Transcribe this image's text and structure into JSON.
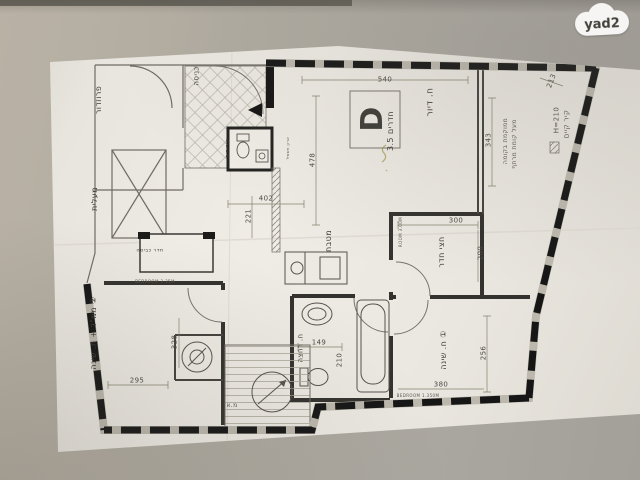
{
  "watermark": {
    "brand": "yad2"
  },
  "floor_plan": {
    "unit": {
      "letter": "D",
      "type_label": "חדרים 3.5",
      "name": "ח. דיור"
    },
    "rooms": [
      {
        "id": "unit-letter",
        "text": "D",
        "x": 373,
        "y": 119,
        "rot": -90,
        "size": 30,
        "bold": true
      },
      {
        "id": "unit-type",
        "text": "חדרים 3.5",
        "x": 391,
        "y": 131,
        "rot": -90,
        "size": 8
      },
      {
        "id": "living-room",
        "text": "ח. דיור",
        "x": 431,
        "y": 102,
        "rot": -90,
        "size": 9
      },
      {
        "id": "kitchen",
        "text": "מטבח",
        "x": 329,
        "y": 241,
        "rot": -90,
        "size": 8
      },
      {
        "id": "half-room",
        "text": "חצי חדר",
        "x": 442,
        "y": 252,
        "rot": -90,
        "size": 8
      },
      {
        "id": "bedroom-1",
        "text": "ח. שינה ①",
        "x": 444,
        "y": 350,
        "rot": -90,
        "size": 8
      },
      {
        "id": "bedroom-2-mamad",
        "text": "ממ\"ד + ח. שינה ②",
        "x": 94,
        "y": 333,
        "rot": -90,
        "size": 8
      },
      {
        "id": "bathroom",
        "text": "ח. רחצה",
        "x": 301,
        "y": 348,
        "rot": -90,
        "size": 7
      },
      {
        "id": "corridor",
        "text": "פרוזדור",
        "x": 99,
        "y": 100,
        "rot": -90,
        "size": 8
      },
      {
        "id": "elevator",
        "text": "מעלית",
        "x": 95,
        "y": 199,
        "rot": -90,
        "size": 8
      },
      {
        "id": "entrance",
        "text": "כניסה",
        "x": 197,
        "y": 76,
        "rot": -90,
        "size": 7
      },
      {
        "id": "laundry",
        "text": "חדר כביסה",
        "x": 150,
        "y": 251,
        "rot": 0,
        "size": 5
      },
      {
        "id": "wc",
        "text": "שירותים",
        "x": 228,
        "y": 148,
        "rot": -90,
        "size": 5
      }
    ],
    "notes": [
      {
        "id": "existing-wall",
        "text": "קיר קיים",
        "x": 567,
        "y": 124,
        "rot": -90,
        "size": 7
      },
      {
        "id": "wall-height",
        "text": "H=210",
        "x": 557,
        "y": 120,
        "rot": -90,
        "size": 7
      },
      {
        "id": "balcony-note-1",
        "text": "ממוקמת בקומה",
        "x": 506,
        "y": 141,
        "rot": -90,
        "size": 6
      },
      {
        "id": "balcony-note-2",
        "text": "מעל קומת מרתף",
        "x": 515,
        "y": 144,
        "rot": -90,
        "size": 6
      },
      {
        "id": "ac-unit",
        "text": "מ.א",
        "x": 232,
        "y": 406,
        "rot": 0,
        "size": 6
      },
      {
        "id": "bedroom2-spec",
        "text": "BEDROOM 3.35M",
        "x": 155,
        "y": 282,
        "rot": 0,
        "size": 4
      },
      {
        "id": "halfroom-spec",
        "text": "ROOM 3.00M",
        "x": 401,
        "y": 232,
        "rot": -90,
        "size": 4
      },
      {
        "id": "bedroom1-spec",
        "text": "BEDROOM 1.350M",
        "x": 418,
        "y": 396,
        "rot": 0,
        "size": 4
      },
      {
        "id": "electric-closet",
        "text": "ארון חשמל",
        "x": 288,
        "y": 148,
        "rot": -90,
        "size": 4
      }
    ],
    "dimensions": [
      {
        "text": "540",
        "x": 385,
        "y": 80,
        "rot": 0
      },
      {
        "text": "343",
        "x": 489,
        "y": 140,
        "rot": -90
      },
      {
        "text": "213",
        "x": 552,
        "y": 81,
        "rot": -70
      },
      {
        "text": "478",
        "x": 313,
        "y": 160,
        "rot": -90
      },
      {
        "text": "402",
        "x": 266,
        "y": 199,
        "rot": 0
      },
      {
        "text": "221",
        "x": 249,
        "y": 216,
        "rot": -90
      },
      {
        "text": "300",
        "x": 456,
        "y": 221,
        "rot": 0
      },
      {
        "text": "200",
        "x": 481,
        "y": 253,
        "rot": -90
      },
      {
        "text": "256",
        "x": 484,
        "y": 353,
        "rot": -90
      },
      {
        "text": "380",
        "x": 441,
        "y": 385,
        "rot": 0
      },
      {
        "text": "149",
        "x": 319,
        "y": 343,
        "rot": 0
      },
      {
        "text": "210",
        "x": 340,
        "y": 360,
        "rot": -90
      },
      {
        "text": "295",
        "x": 137,
        "y": 381,
        "rot": 0
      },
      {
        "text": "328",
        "x": 175,
        "y": 342,
        "rot": -90
      }
    ]
  }
}
